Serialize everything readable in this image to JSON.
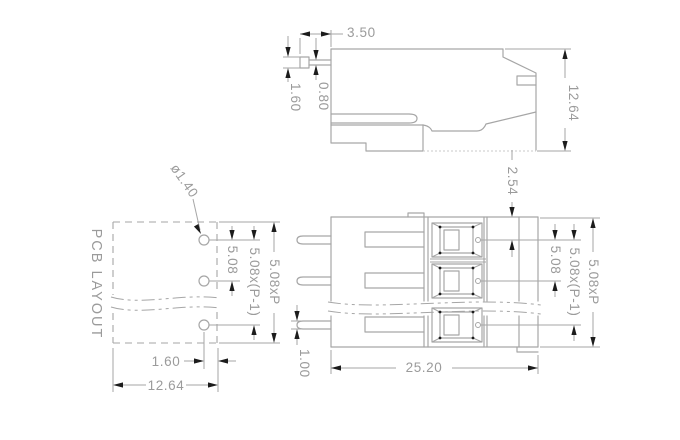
{
  "drawing": {
    "top_view": {
      "dim_tab_length": "3.50",
      "dim_tab_tip_width": "1.60",
      "dim_tab_thickness": "0.80",
      "dim_height": "12.64"
    },
    "pcb_layout": {
      "label": "PCB LAYOUT",
      "hole_diameter": "ø1.40",
      "pitch": "5.08",
      "pitch_span": "5.08x(P-1)",
      "total_span": "5.08xP",
      "hole_to_edge": "1.60",
      "width": "12.64"
    },
    "front_view": {
      "top_to_first_pole": "2.54",
      "pin_width": "1.00",
      "total_width": "25.20",
      "pitch": "5.08",
      "pitch_span": "5.08x(P-1)",
      "total_span": "5.08xP"
    },
    "colors": {
      "background": "#ffffff",
      "line": "#a6a6a6",
      "hidden_line": "#c9c9c9",
      "text": "#9b9b9b",
      "arrow": "#1c1c1c"
    }
  }
}
